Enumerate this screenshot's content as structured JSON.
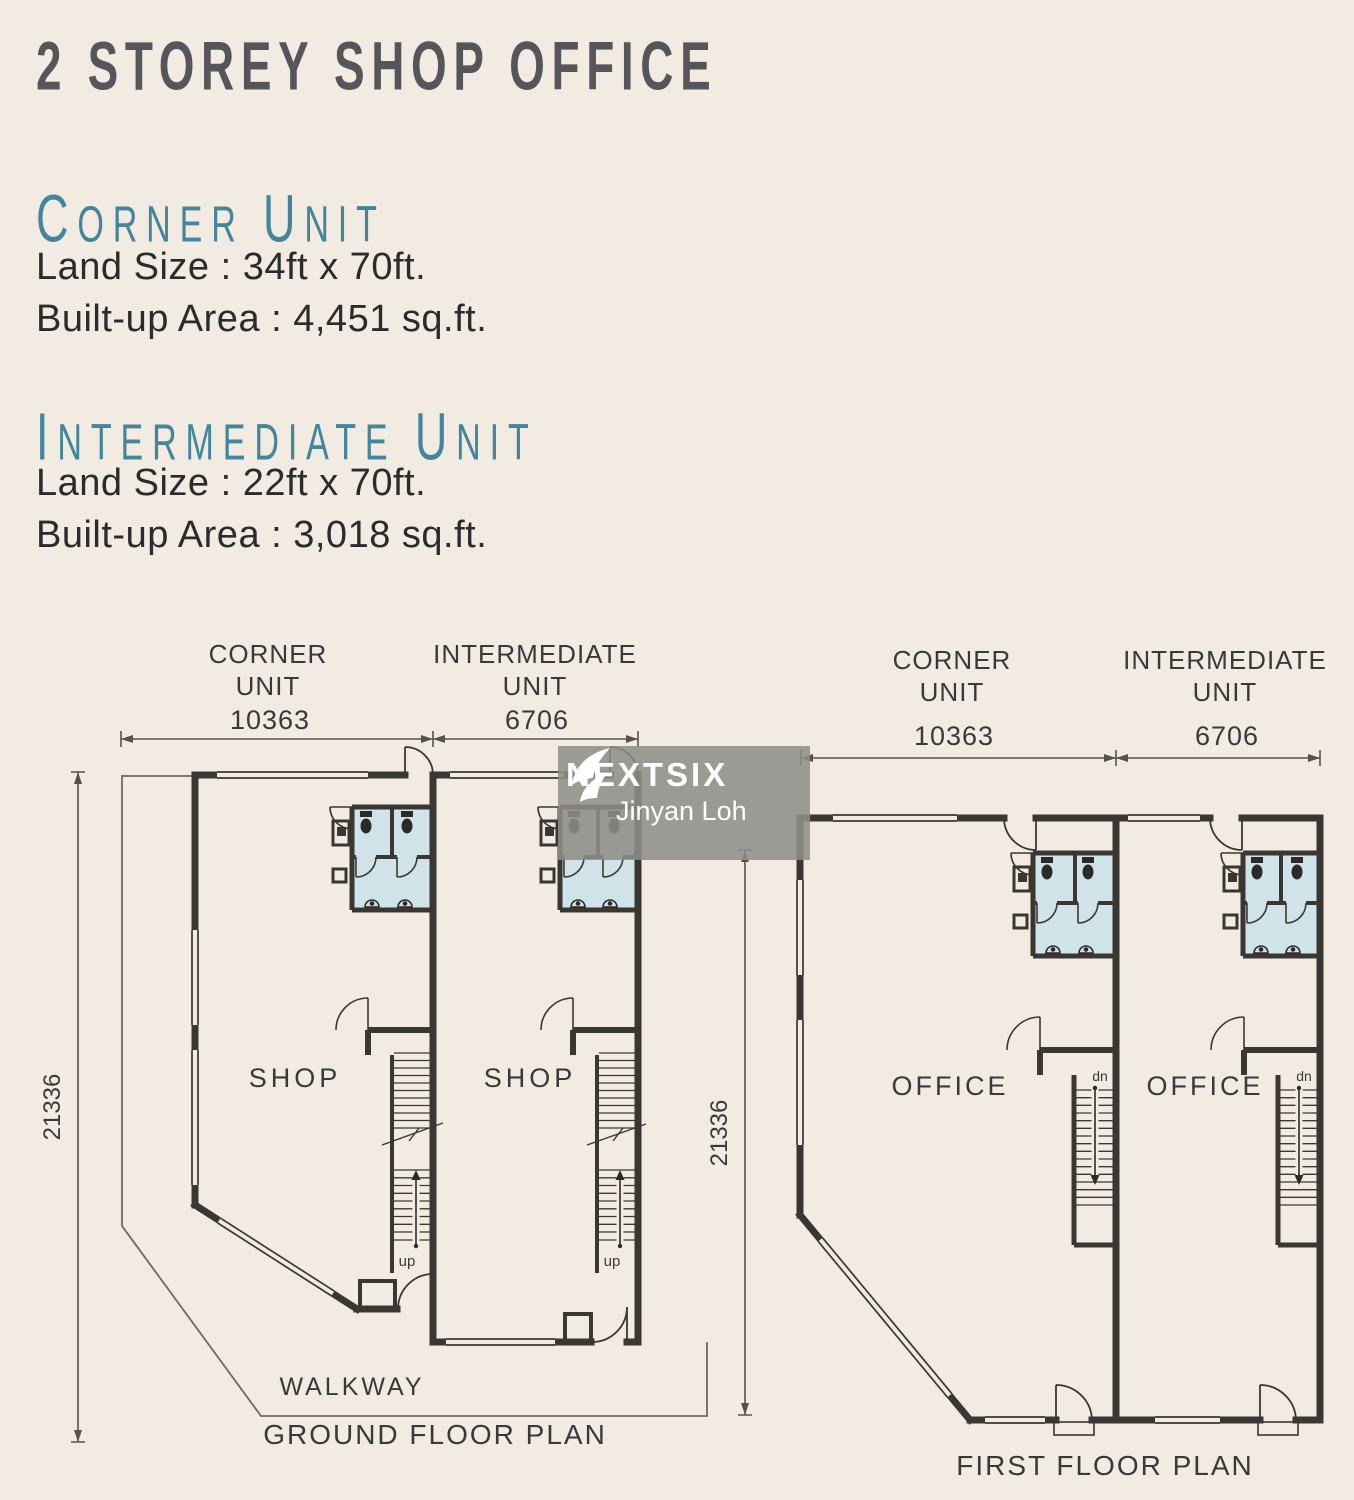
{
  "header": {
    "title": "2 STOREY SHOP OFFICE",
    "units": [
      {
        "name": "CORNER UNIT",
        "land_size": "Land Size : 34ft x 70ft.",
        "built_up": "Built-up Area : 4,451 sq.ft."
      },
      {
        "name": "INTERMEDIATE UNIT",
        "land_size": "Land Size : 22ft x 70ft.",
        "built_up": "Built-up Area : 3,018 sq.ft."
      }
    ]
  },
  "watermark": {
    "brand": "NEXTSIX",
    "agent": "Jinyan Loh"
  },
  "dimensions": {
    "corner_width": "10363",
    "intermediate_width": "6706",
    "depth": "21336"
  },
  "plans": {
    "ground": {
      "title": "GROUND FLOOR PLAN",
      "corner_line1": "CORNER",
      "corner_line2": "UNIT",
      "intermediate_line1": "INTERMEDIATE",
      "intermediate_line2": "UNIT",
      "room_corner": "SHOP",
      "room_intermediate": "SHOP",
      "stair_label": "up",
      "walkway": "WALKWAY"
    },
    "first": {
      "title": "FIRST FLOOR PLAN",
      "corner_line1": "CORNER",
      "corner_line2": "UNIT",
      "intermediate_line1": "INTERMEDIATE",
      "intermediate_line2": "UNIT",
      "room_corner": "OFFICE",
      "room_intermediate": "OFFICE",
      "stair_label": "dn"
    }
  },
  "colors": {
    "background": "#f1ebe1",
    "wall": "#3a3733",
    "teal_heading": "#43859c",
    "title_gray": "#55565a",
    "toilet_floor": "#cfe3e9",
    "watermark_bg": "#8f8d89",
    "watermark_text": "#ffffff"
  }
}
